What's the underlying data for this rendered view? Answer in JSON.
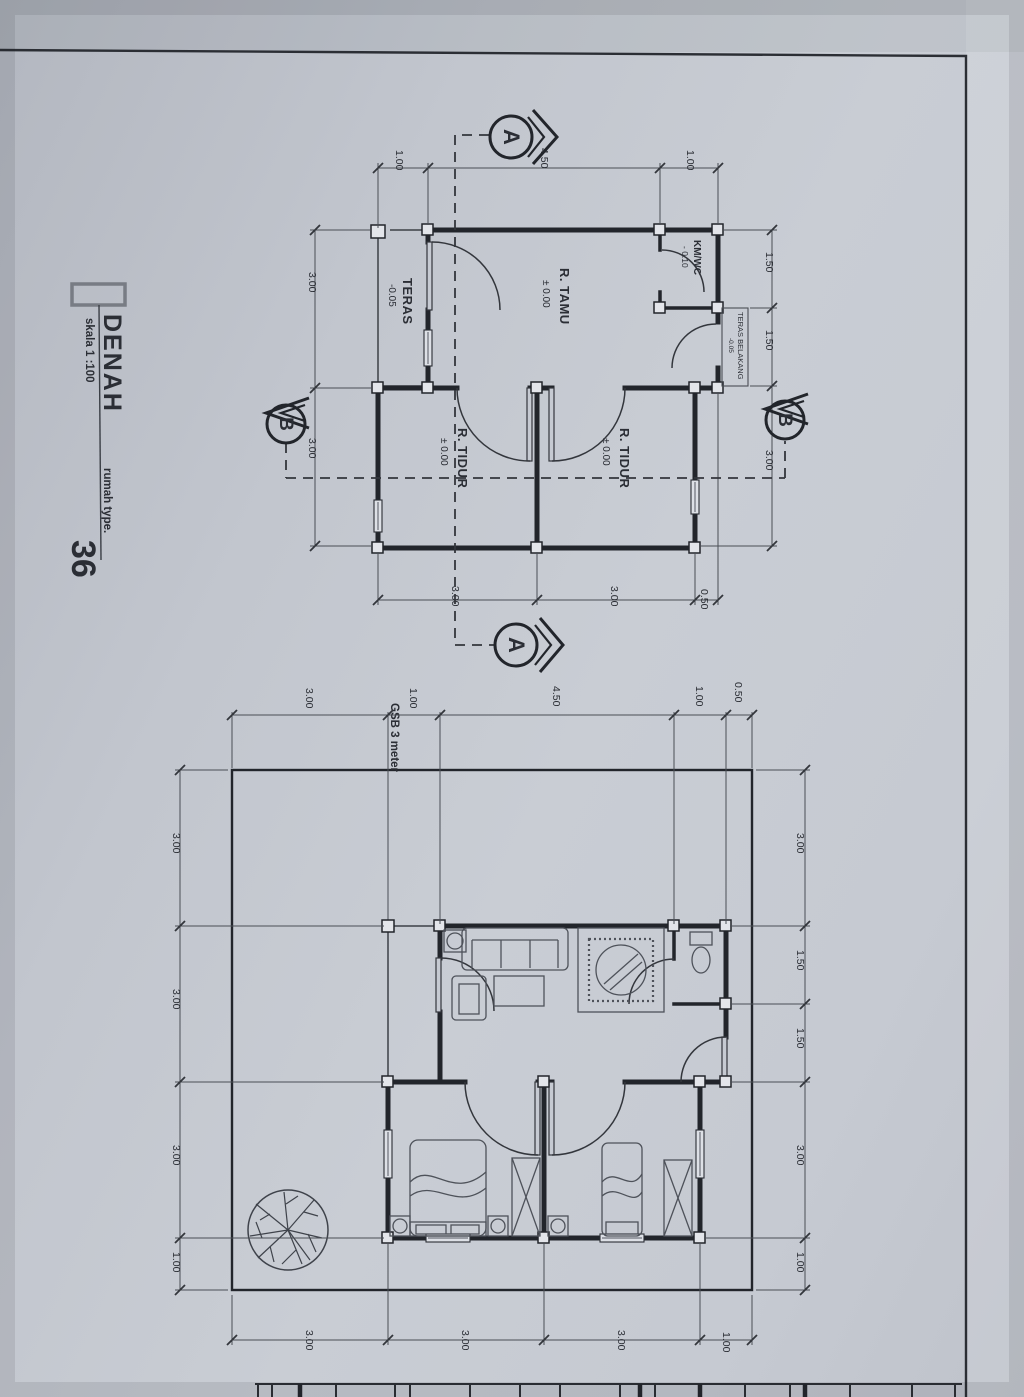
{
  "sheet": {
    "title": "DENAH",
    "scale_label": "skala 1 :100",
    "type_label": "rumah type.",
    "type_number": "36"
  },
  "floor_plan": {
    "rooms": {
      "teras": {
        "name": "TERAS",
        "level": "-0.05"
      },
      "r_tamu": {
        "name": "R. TAMU",
        "level": "± 0.00"
      },
      "km_wc": {
        "name": "KM/WC",
        "level": "- 0.10"
      },
      "teras_belakang": {
        "name": "TERAS BELAKANG",
        "level": "-0.05"
      },
      "r_tidur_1": {
        "name": "R. TIDUR",
        "level": "± 0.00"
      },
      "r_tidur_2": {
        "name": "R. TIDUR",
        "level": "± 0.00"
      }
    },
    "section_markers": {
      "a": "A",
      "b": "B"
    },
    "dims": {
      "top": [
        "1.00",
        "4.50",
        "1.00"
      ],
      "left": [
        "3.00",
        "3.00"
      ],
      "right": [
        "1.50",
        "1.50",
        "3.00"
      ],
      "bottom": [
        "3.00",
        "3.00",
        "0.50"
      ]
    }
  },
  "site_plan": {
    "gsb_label": "GSB 3 meter",
    "dims": {
      "top": [
        "3.00",
        "1.00",
        "4.50",
        "1.00",
        "0.50"
      ],
      "left": [
        "3.00",
        "3.00",
        "3.00",
        "1.00"
      ],
      "right": [
        "3.00",
        "1.50",
        "1.50",
        "3.00",
        "1.00"
      ],
      "bottom": [
        "3.00",
        "3.00",
        "3.00",
        "1.00"
      ]
    }
  },
  "colors": {
    "paper": "#c6cad2",
    "ink": "#2b2e35",
    "wall": "#22252b"
  }
}
